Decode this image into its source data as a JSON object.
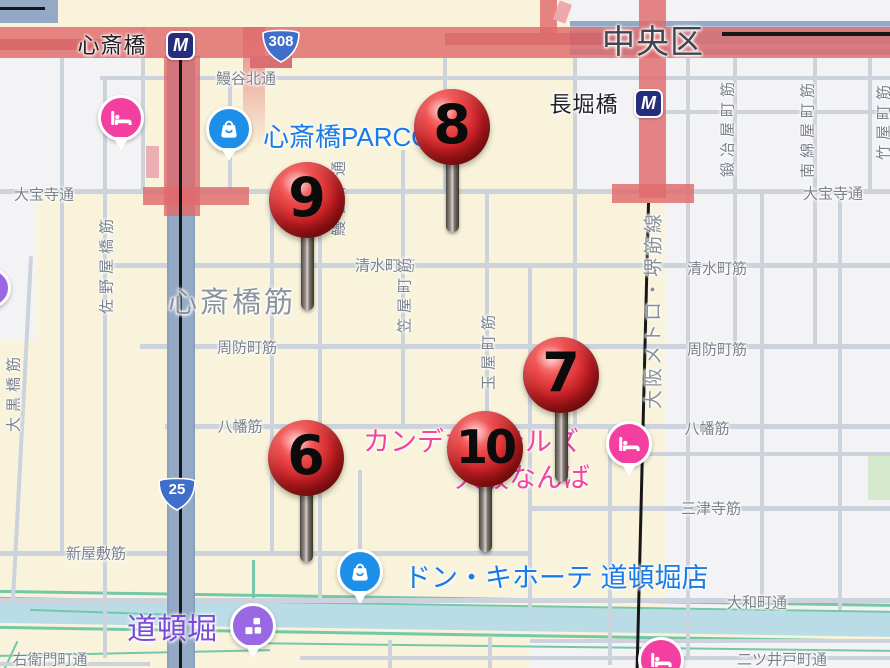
{
  "map_title": "Shinsaibashi / Dotonbori area map",
  "districts": {
    "ward": "中央区",
    "shopping_street": "心斎橋筋",
    "dotonbori": "道頓堀"
  },
  "stations": [
    {
      "name": "心斎橋"
    },
    {
      "name": "長堀橋"
    }
  ],
  "metro_logo": "M",
  "route_shields": [
    {
      "number": "308"
    },
    {
      "number": "25"
    }
  ],
  "transit_line_label": "大阪メトロ・堺筋線",
  "streets_horizontal": [
    "鰻谷北通",
    "大宝寺通",
    "大宝寺通",
    "清水町筋",
    "清水町筋",
    "周防町筋",
    "周防町筋",
    "八幡筋",
    "八幡筋",
    "三津寺筋",
    "新屋敷筋",
    "大和町通",
    "二ツ井戸町通",
    "右衛門町通"
  ],
  "streets_vertical": [
    "佐野屋橋筋",
    "大黒橋筋",
    "鰻谷中通",
    "笠屋町筋",
    "玉屋町筋",
    "鍛冶屋町筋",
    "南綿屋町筋",
    "竹屋町筋"
  ],
  "pois": {
    "parco": {
      "name": "心斎橋PARCO"
    },
    "candeo_line1": "カンデオホテルズ",
    "candeo_line2": "大阪なんば",
    "donki": {
      "name": "ドン・キホーテ 道頓堀店"
    }
  },
  "pins": [
    {
      "label": "6"
    },
    {
      "label": "7"
    },
    {
      "label": "8"
    },
    {
      "label": "9"
    },
    {
      "label": "10"
    }
  ],
  "colors": {
    "poi_blue": "#187be8",
    "poi_pink": "#f2459c",
    "poi_purple": "#7b49d8",
    "hotel_icon": "#f23fa0",
    "shopping_icon": "#1e8fe8",
    "landmark_icon": "#9a68e4",
    "metro_navy": "#242e7c",
    "shield_blue": "#3f6ecb",
    "major_road_red": "#e16a6c",
    "boulevard_blue": "#93a9c6",
    "canal": "#b9dce6",
    "pin_red": "#c51f24"
  }
}
